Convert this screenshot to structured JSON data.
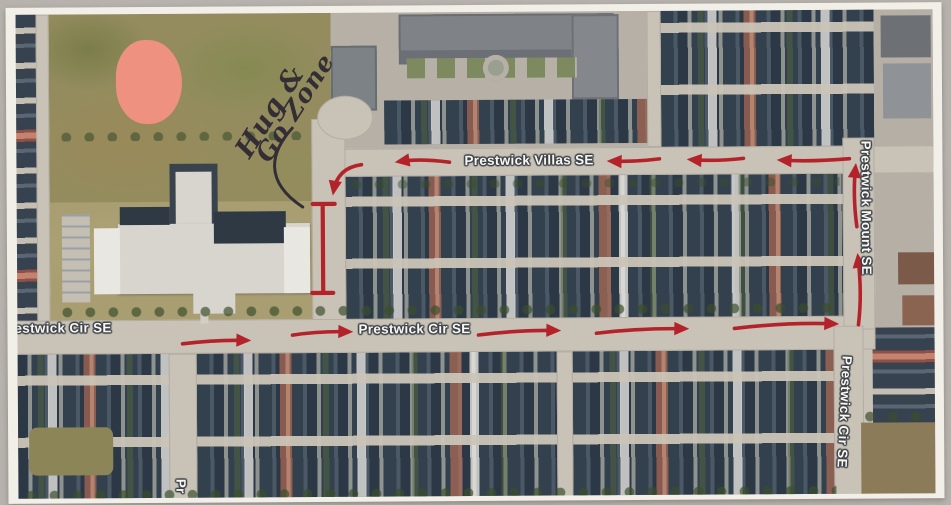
{
  "photo": {
    "backdrop_color": "#b7b2ad",
    "paper_color": "#f2efe9",
    "kind": "photo of printed satellite map"
  },
  "map": {
    "street_labels": {
      "villas": "Prestwick Villas SE",
      "cir_center": "Prestwick Cir SE",
      "cir_left_partial": "estwick Cir SE",
      "mount": "Prestwick Mount SE",
      "cir_south": "Prestwick Cir SE",
      "bottom_partial": "Pr"
    },
    "handwriting": {
      "line1": "Hug &",
      "line2": "Go Zone",
      "ink_color": "#332e35"
    },
    "route": {
      "color": "#b5232a",
      "arrows": [
        {
          "street": "Prestwick Cir SE",
          "direction": "east",
          "count": 5
        },
        {
          "street": "Prestwick Mount SE",
          "direction": "north",
          "count": 2
        },
        {
          "street": "Prestwick Villas SE",
          "direction": "west",
          "count": 4
        },
        {
          "street": "school frontage",
          "direction": "south into zone",
          "count": 1
        }
      ],
      "zone_marker": "red bracket (I-beam) along school frontage"
    },
    "landmarks": {
      "ball_diamond": "salmon infield circle in park",
      "school": "large light-gray school building",
      "townhouse_complex": "gray-roof condo complex top center",
      "vacant_lot": "brown lot bottom right"
    },
    "colors": {
      "road": "#c8c2b7",
      "house_roof_dark": "#33404d",
      "park": "#948c5f",
      "school_grass": "#a89e72",
      "ball_diamond": "#ef9180",
      "label_fill": "#f8f7f4",
      "label_outline": "#3c4146",
      "vacant_lot": "#8b7b58"
    }
  }
}
